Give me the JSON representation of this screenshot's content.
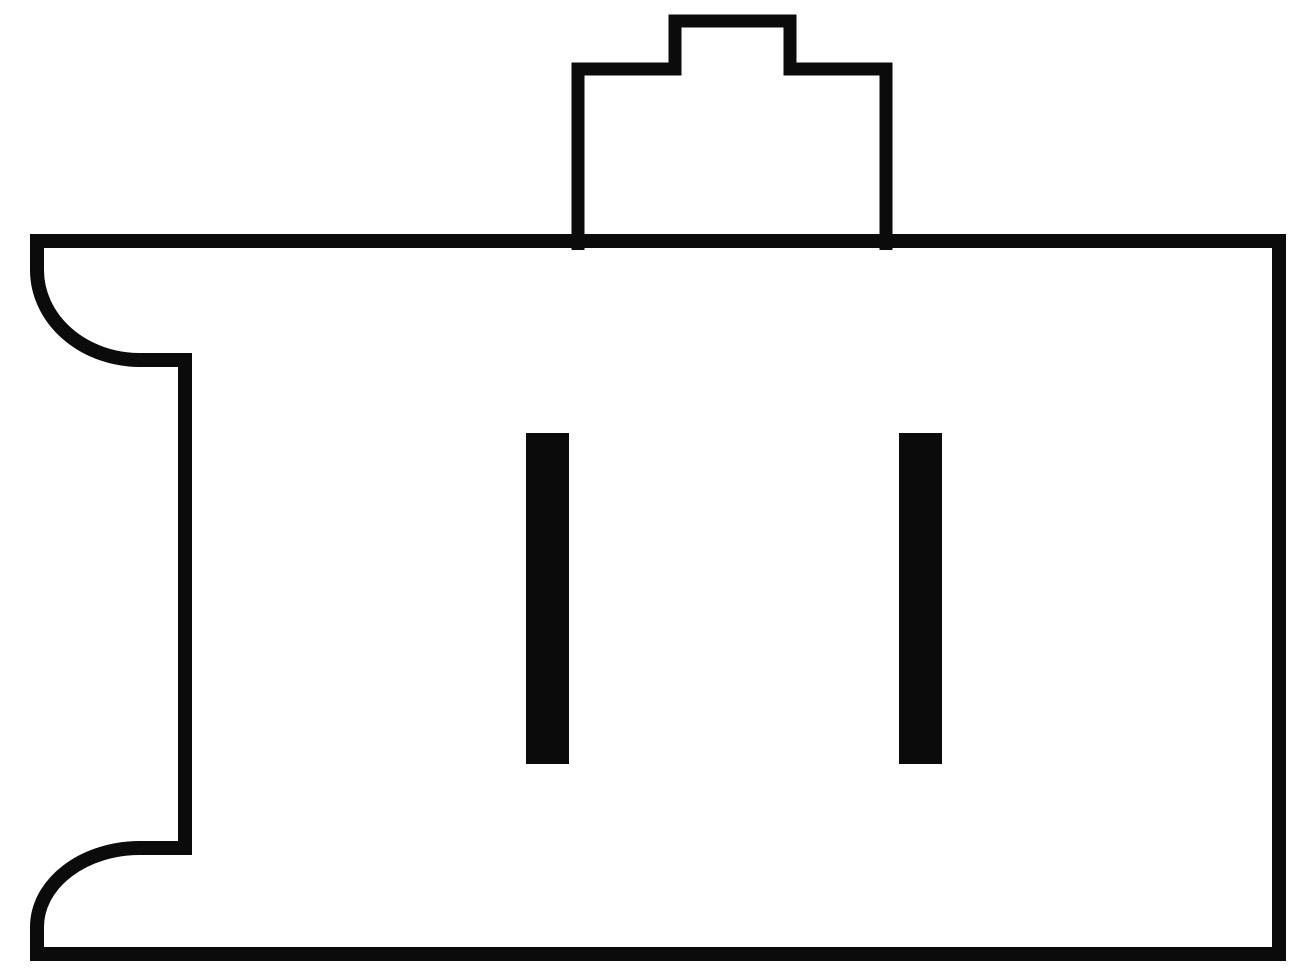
{
  "canvas": {
    "width": 1300,
    "height": 977,
    "background_color": "#ffffff"
  },
  "diagram": {
    "type": "connector-side-view-line-drawing",
    "ink_color": "#0b0b0b",
    "body_stroke_width": 14,
    "key_stroke_width": 13,
    "body_outline_path": "M 37 241 L 1279 241 L 1279 954 L 37 954 L 37 927 A 103 79 0 0 1 140 848 L 185 848 L 185 360 L 140 360 A 103 90 0 0 1 37 270 Z",
    "key_outline_path": "M 578 250 L 578 69 L 675 69 L 675 21 L 790 21 L 790 69 L 886 69 L 886 250",
    "pins": [
      {
        "name": "pin-1",
        "x": 526,
        "y": 433,
        "width": 43,
        "height": 331
      },
      {
        "name": "pin-2",
        "x": 899,
        "y": 433,
        "width": 43,
        "height": 331
      }
    ]
  }
}
